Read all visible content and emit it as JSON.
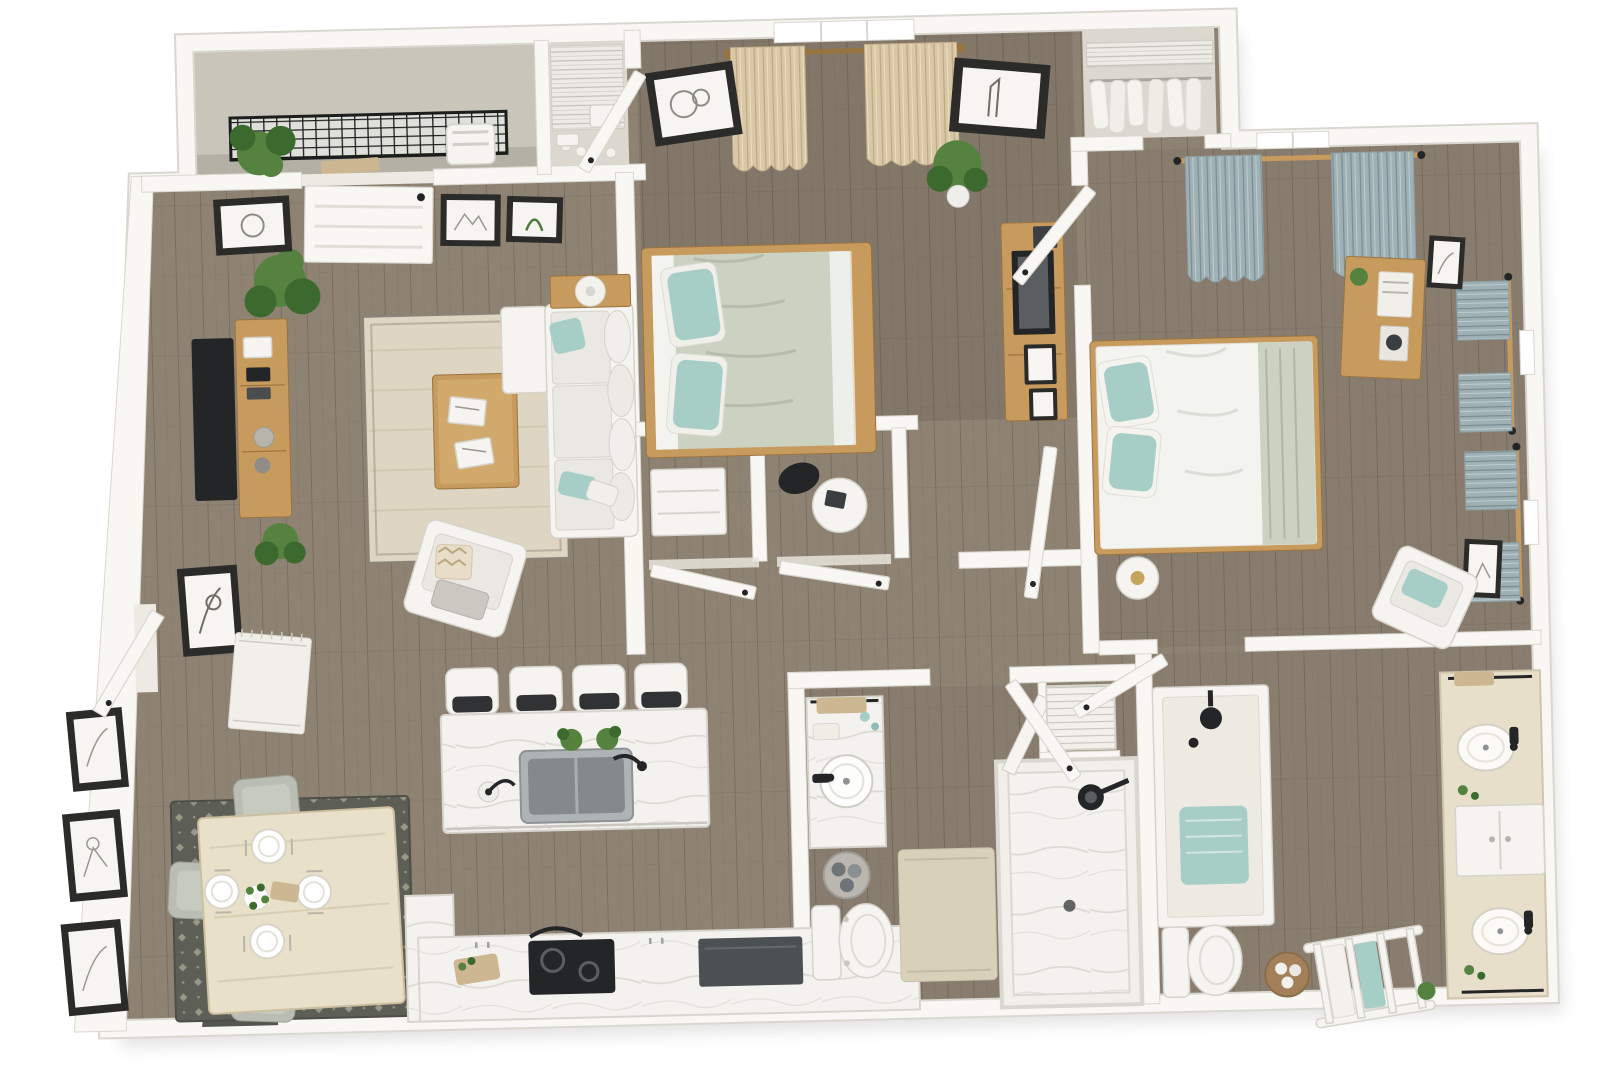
{
  "palette": {
    "pageBg": "#ffffff",
    "wall": "#f8f7f3",
    "wallEdge": "#d9d7cf",
    "floorWood": "#8e8273",
    "plankLine": "rgba(52,41,28,0.22)",
    "concrete": "#c9c5bb",
    "closetFloor": "#dcd8d0",
    "rugCream": "#ded5c2",
    "rugDark": "#5d5f57",
    "rugDot": "#c9c4ad",
    "rugWhite": "#f1efe9",
    "woodOak": "#c79a5e",
    "woodOakDark": "#9a7440",
    "whiteFurn": "#f5f4f0",
    "furnEdge": "#d5d3cb",
    "cushion": "#e9e8e3",
    "cushionShade": "#d9d8d1",
    "teal": "#a7cdc7",
    "sage": "#ccd2c2",
    "duvetWhite": "#f3f3ef",
    "beigeCurtain": "#d9c7a5",
    "blueCurtain": "#9fb1b5",
    "steel": "#aeb3b5",
    "steelDeep": "#84898c",
    "black": "#232527",
    "appliance": "#4b5053",
    "marble": "#f3f2ee",
    "marbleVein": "#dbd9d2",
    "green": "#55833f",
    "greenDeep": "#3c6a2e",
    "tan": "#cdb792",
    "gold": "#c7a45c",
    "chairGray": "#b9bdb3",
    "frameDark": "#2b2b29",
    "frameMat": "#f6f5f1",
    "basketBrown": "#a3805a",
    "towelGray": "#6f7476",
    "railDark": "#1c1d1d"
  },
  "scene": {
    "type": "3d-top-down-floor-plan-render",
    "bedrooms": 2,
    "bathrooms": 2,
    "rooms": [
      {
        "id": "balcony",
        "furniture": [
          "metal-railing",
          "potted-plant",
          "outdoor-chair"
        ]
      },
      {
        "id": "living-room",
        "furniture": [
          "wall-tv",
          "media-console",
          "potted-plants",
          "area-rug",
          "coffee-table",
          "sectional-sofa",
          "accent-chair",
          "console-table",
          "table-lamp",
          "wall-art",
          "patio-door",
          "entry-door",
          "entry-rug",
          "doormat"
        ]
      },
      {
        "id": "dining-area",
        "furniture": [
          "dining-table",
          "dining-chairs-x4",
          "place-settings-x4",
          "flower-centerpiece",
          "patterned-rug",
          "wall-art-x3"
        ]
      },
      {
        "id": "kitchen",
        "furniture": [
          "island",
          "bar-stools-x4",
          "double-sink",
          "faucet",
          "herb-plants",
          "paper-towel-holder",
          "counter",
          "cooktop",
          "dark-appliance",
          "cutting-board"
        ]
      },
      {
        "id": "bedroom-1",
        "furniture": [
          "queen-bed",
          "teal-pillows",
          "window",
          "beige-curtains",
          "wall-art-x2",
          "dresser-with-tv",
          "floor-plant",
          "closet-nook-dresser",
          "desk-nook-table",
          "desk-chair"
        ]
      },
      {
        "id": "walk-in-closet-1",
        "furniture": [
          "wire-shelving",
          "stored-items"
        ]
      },
      {
        "id": "bedroom-2",
        "furniture": [
          "queen-bed",
          "teal-pillows",
          "sage-throw",
          "nightstand-with-lamp",
          "gray-curtains",
          "windows-x3",
          "dresser-with-books",
          "wall-art-x2",
          "accent-chair"
        ]
      },
      {
        "id": "walk-in-closet-2",
        "furniture": [
          "wire-shelf",
          "hanging-clothes"
        ]
      },
      {
        "id": "bathroom-1",
        "furniture": [
          "vanity-sink",
          "towel-basket",
          "toilet",
          "bath-mat",
          "walk-in-shower",
          "louvered-laundry-closet"
        ]
      },
      {
        "id": "bathroom-2",
        "furniture": [
          "tub-shower",
          "teal-bath-mat",
          "toilet",
          "woven-basket",
          "towel-ladder",
          "double-vanity",
          "linen-cabinet",
          "wall-art"
        ]
      },
      {
        "id": "hallway",
        "furniture": [
          "closet-door-x2",
          "linen-closet-door"
        ]
      }
    ]
  }
}
